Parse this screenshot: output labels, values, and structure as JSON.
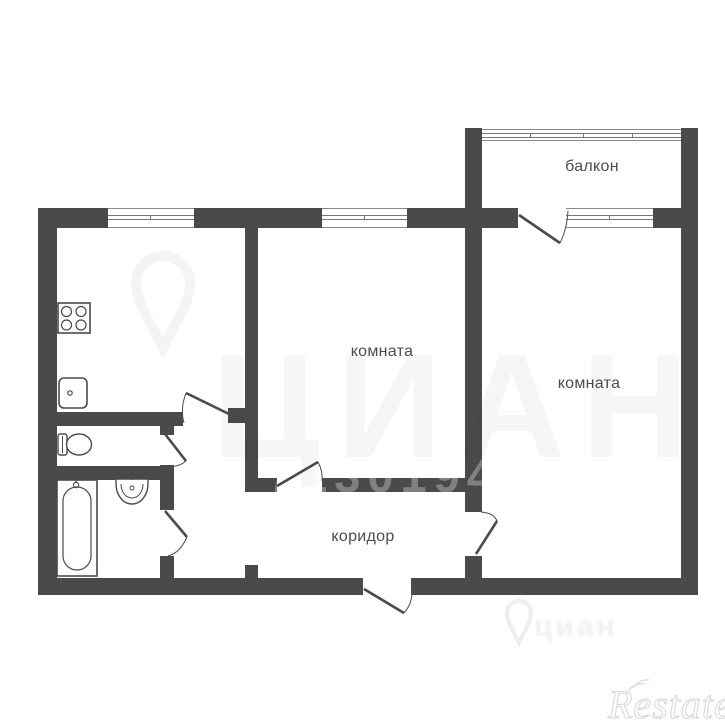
{
  "plan": {
    "type": "apartment-floor-plan",
    "rooms": {
      "balcony": "балкон",
      "room1": "комната",
      "room2": "комната",
      "corridor": "коридор"
    },
    "fixtures": [
      "stove",
      "kitchen-sink",
      "toilet",
      "bathtub",
      "washbasin"
    ],
    "features": [
      "windows",
      "doors-with-swing-arcs",
      "entrance-door"
    ]
  },
  "watermarks": {
    "cian_big": "ЦИАН",
    "cian_small": "циан",
    "listing_number": "7130194",
    "restate": "Restate"
  },
  "colors": {
    "wall": "#4a4a4a",
    "background": "#ffffff",
    "label": "#4c4c4c",
    "watermark_light": "#ececec"
  }
}
